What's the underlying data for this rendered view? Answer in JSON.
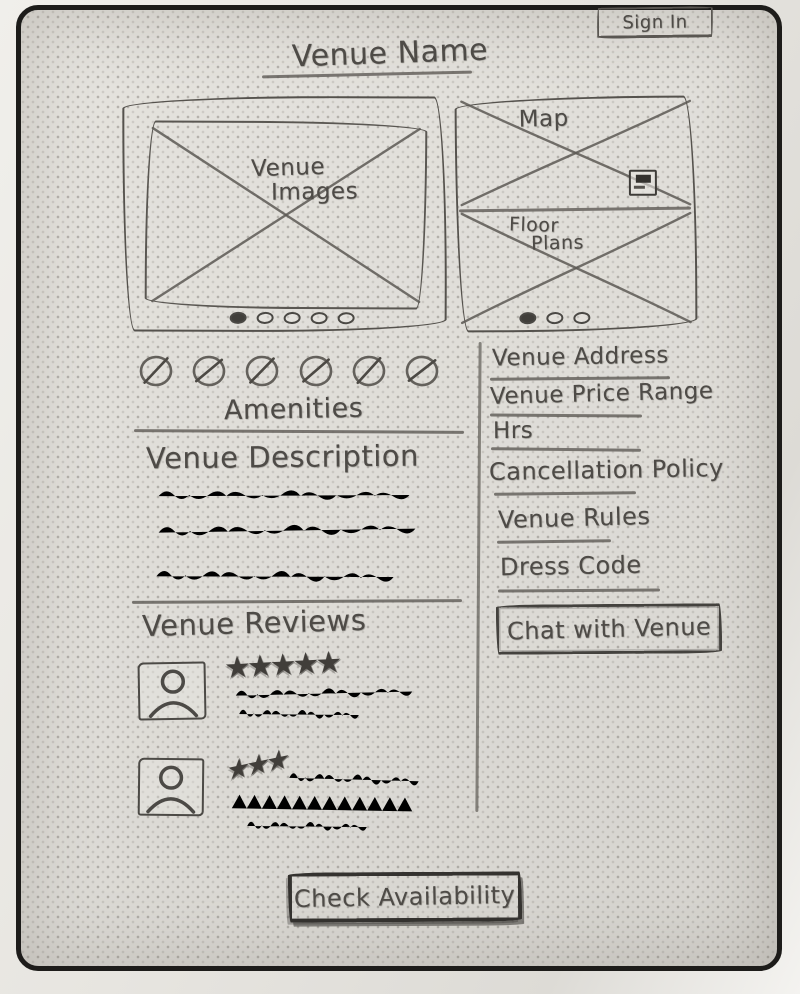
{
  "header": {
    "sign_in_label": "Sign In",
    "title": "Venue Name"
  },
  "gallery": {
    "label_line1": "Venue",
    "label_line2": "Images",
    "dot_count": 5
  },
  "map_panel": {
    "map_label": "Map",
    "floor_label_line1": "Floor",
    "floor_label_line2": "Plans",
    "dot_count": 3
  },
  "amenities": {
    "label": "Amenities",
    "icon_count": 6
  },
  "description": {
    "heading": "Venue Description",
    "placeholder_line_count": 3
  },
  "reviews": {
    "heading": "Venue Reviews",
    "items": [
      {
        "stars": 5,
        "stars_text": "★★★★★",
        "text_line_count": 2
      },
      {
        "stars": 3,
        "stars_text": "★★★",
        "text_line_count": 3
      }
    ]
  },
  "info_panel": {
    "items": [
      "Venue Address",
      "Venue Price Range",
      "Hrs",
      "Cancellation Policy",
      "Venue Rules",
      "Dress Code"
    ],
    "chat_button_label": "Chat with Venue"
  },
  "footer": {
    "check_availability_label": "Check Availability"
  },
  "icons": {
    "amenity_icon": "circle-slash-placeholder",
    "avatar_icon": "person-silhouette",
    "map_control_icon": "small-square-map-control",
    "star_icon": "★",
    "carousel_dot": "oval-dot",
    "image_placeholder": "crossed-box"
  },
  "colors": {
    "pencil": "#55524d",
    "pencil_dark": "#3a3834",
    "paper": "#dfddd8",
    "frame": "#1d1c1a"
  }
}
